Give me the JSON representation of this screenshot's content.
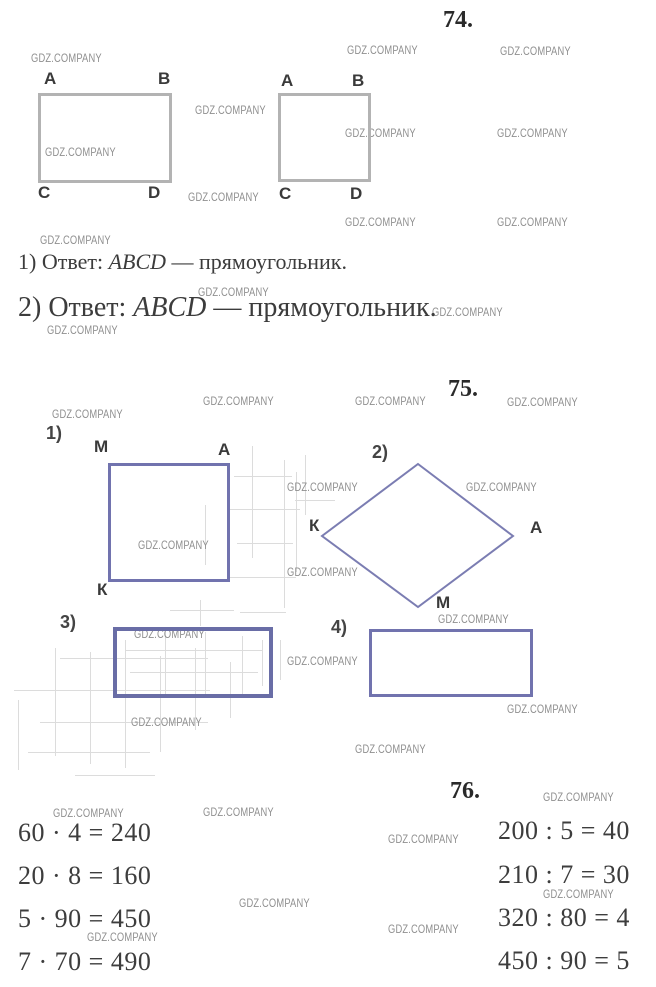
{
  "watermark": {
    "text": "GDZ.COMPANY",
    "color": "#8f8f8f"
  },
  "colors": {
    "figure_gray_border": "#b3b3b3",
    "figure_blue_border": "#7173ae",
    "rhombus_stroke": "#7b7db2",
    "heading_text": "#2a2a2a",
    "body_text": "#3c3c3c",
    "sketch_line": "#dcdcdc"
  },
  "problem74": {
    "number": "74.",
    "figure1": {
      "tl": "A",
      "tr": "B",
      "bl": "C",
      "br": "D"
    },
    "figure2": {
      "tl": "A",
      "tr": "B",
      "bl": "C",
      "br": "D"
    },
    "answer1": {
      "prefix": "1) Ответ: ",
      "name": "ABCD",
      "suffix": " — прямоугольник."
    },
    "answer2": {
      "prefix": "2) Ответ: ",
      "name": "ABCD",
      "suffix": " — прямоугольник."
    }
  },
  "problem75": {
    "number": "75.",
    "item1": {
      "label": "1)",
      "shape": "square",
      "tl": "М",
      "tr": "А",
      "bl": "К"
    },
    "item2": {
      "label": "2)",
      "shape": "rhombus",
      "left": "К",
      "right": "А",
      "bottom": "М"
    },
    "item3": {
      "label": "3)",
      "shape": "rectangle"
    },
    "item4": {
      "label": "4)",
      "shape": "rectangle"
    }
  },
  "problem76": {
    "number": "76.",
    "left_equations": [
      "60 · 4 = 240",
      "20 · 8 = 160",
      "5 · 90 = 450",
      "7 · 70 = 490"
    ],
    "right_equations": [
      "200 : 5 = 40",
      "210 : 7 = 30",
      "320 : 80 = 4",
      "450 : 90 = 5"
    ]
  }
}
